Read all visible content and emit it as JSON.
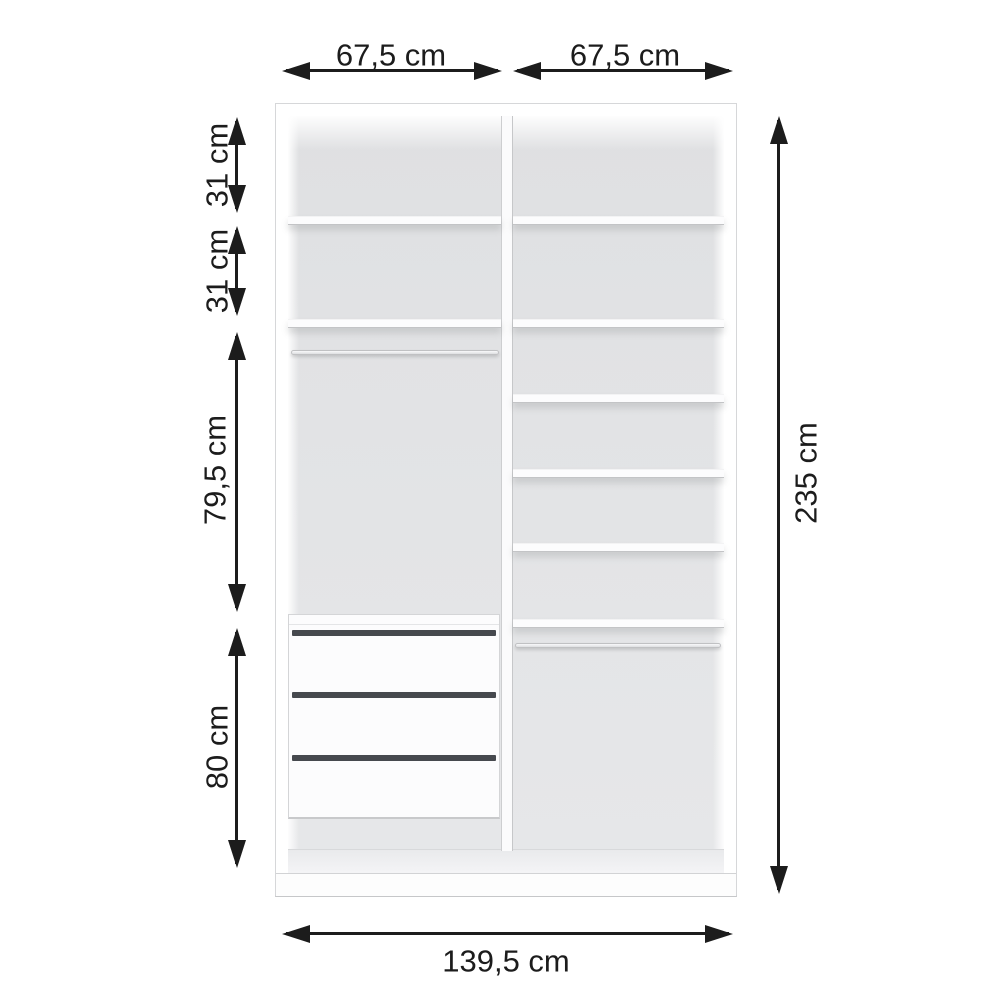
{
  "diagram": {
    "kind": "wardrobe-interior-dimension-diagram",
    "unit": "cm"
  },
  "dimensions": {
    "left_column_width": {
      "label": "67,5 cm",
      "value_cm": 67.5
    },
    "right_column_width": {
      "label": "67,5 cm",
      "value_cm": 67.5
    },
    "top_section_height": {
      "label": "31 cm",
      "value_cm": 31
    },
    "second_section_height": {
      "label": "31 cm",
      "value_cm": 31
    },
    "hanging_section_height": {
      "label": "79,5 cm",
      "value_cm": 79.5
    },
    "drawer_section_height": {
      "label": "80 cm",
      "value_cm": 80
    },
    "total_height": {
      "label": "235 cm",
      "value_cm": 235
    },
    "total_width": {
      "label": "139,5 cm",
      "value_cm": 139.5
    }
  },
  "structure": {
    "left_column": {
      "shelf_count": 2,
      "clothes_rail_count": 1,
      "drawer_count": 3
    },
    "right_column": {
      "shelf_count": 6,
      "clothes_rail_count": 1
    }
  },
  "colors": {
    "dim": "#1c1c1c",
    "cabinet": "#ffffff",
    "interior": "#e2e3e5",
    "edge": "#c9cacc",
    "drawer_gap": "#46494e"
  }
}
